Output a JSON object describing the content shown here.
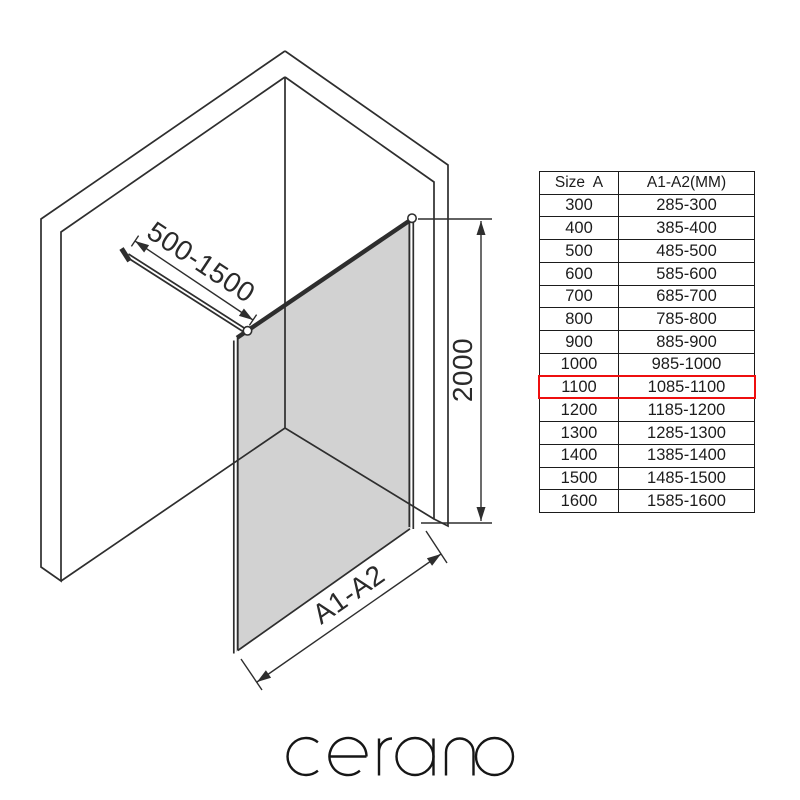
{
  "brand": {
    "name": "cerano"
  },
  "diagram": {
    "type": "isometric walk-in shower glass screen with stabilizer bar",
    "labels": {
      "bar_range": "500-1500",
      "height": "2000",
      "width": "A1-A2"
    },
    "glass_color": "#d2d2d2",
    "line_color": "#2e2e2e"
  },
  "table": {
    "headers": [
      "Size  A",
      "A1-A2(MM)"
    ],
    "highlighted_size": "1100",
    "highlight_color": "#ee0f0f",
    "rows": [
      {
        "size": "300",
        "range": "285-300"
      },
      {
        "size": "400",
        "range": "385-400"
      },
      {
        "size": "500",
        "range": "485-500"
      },
      {
        "size": "600",
        "range": "585-600"
      },
      {
        "size": "700",
        "range": "685-700"
      },
      {
        "size": "800",
        "range": "785-800"
      },
      {
        "size": "900",
        "range": "885-900"
      },
      {
        "size": "1000",
        "range": "985-1000"
      },
      {
        "size": "1100",
        "range": "1085-1100"
      },
      {
        "size": "1200",
        "range": "1185-1200"
      },
      {
        "size": "1300",
        "range": "1285-1300"
      },
      {
        "size": "1400",
        "range": "1385-1400"
      },
      {
        "size": "1500",
        "range": "1485-1500"
      },
      {
        "size": "1600",
        "range": "1585-1600"
      }
    ]
  }
}
